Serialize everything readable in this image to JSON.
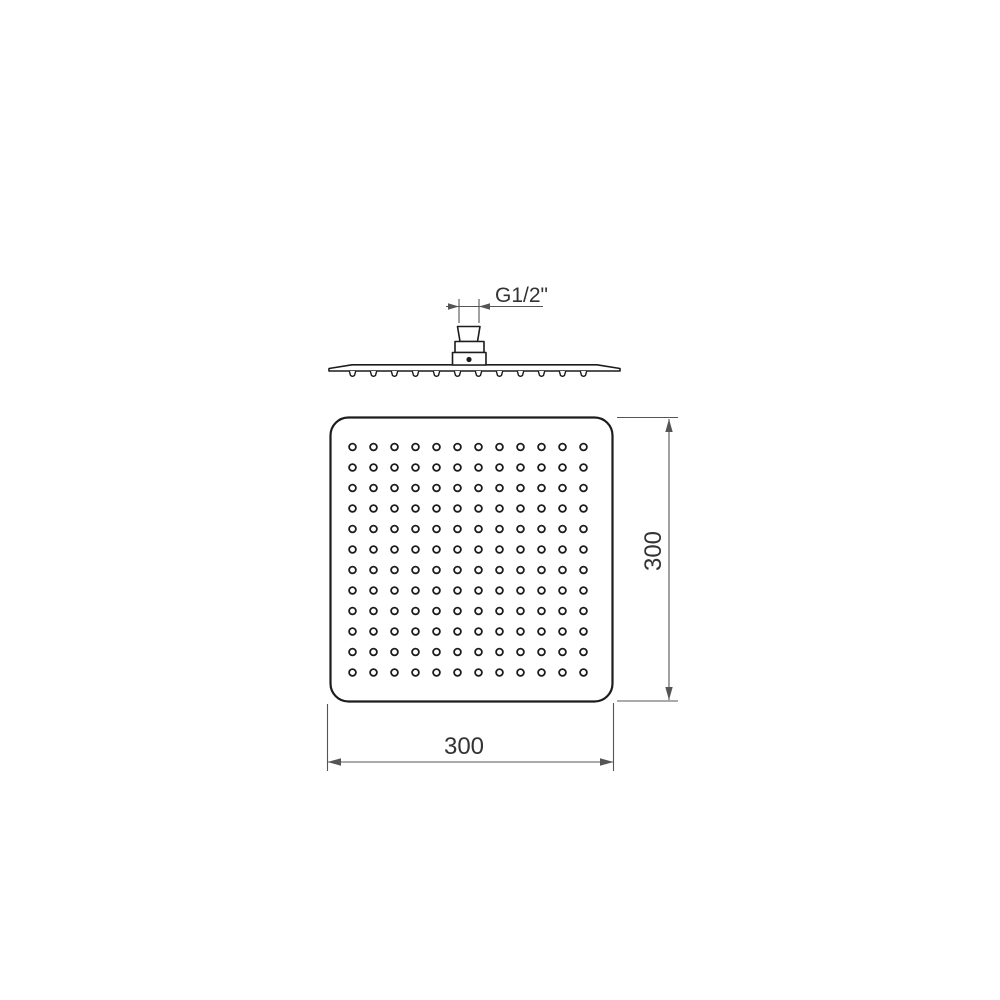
{
  "diagram": {
    "labels": {
      "thread": "G1/2\"",
      "width": "300",
      "height": "300"
    },
    "nozzle_grid": {
      "rows": 12,
      "cols": 12
    },
    "side_nozzle_count": 12,
    "colors": {
      "line": "#1c1c1c",
      "dim": "#555555",
      "text": "#333333",
      "bg": "#ffffff"
    },
    "layout": {
      "grid_x0": 352.5,
      "grid_y0": 447,
      "grid_dx": 21,
      "grid_dy": 20.5,
      "nozzle_radius": 3.4,
      "side_bump_y": 371
    }
  }
}
